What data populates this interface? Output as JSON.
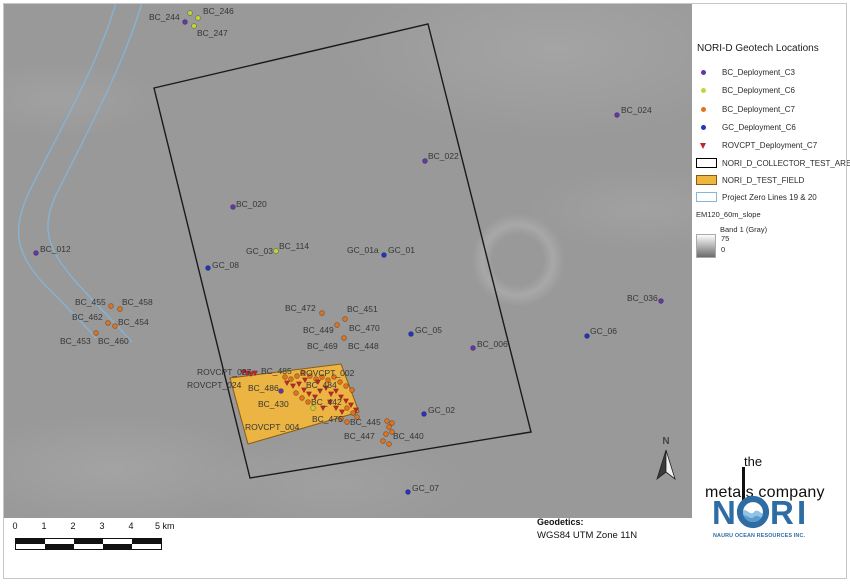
{
  "colors": {
    "map_bg": "#999999",
    "c3": "#6138a8",
    "c6": "#c3d438",
    "c7": "#e0731d",
    "gc": "#2433c0",
    "rovcpt": "#c0272d",
    "area_border": "#1a1a1a",
    "test_field_fill": "#eeb53f",
    "test_field_border": "#8a5a10",
    "zero_line": "#85b5d8",
    "nori_blue": "#2e6da4",
    "nori_light": "#8ec3e6"
  },
  "map": {
    "north": "N",
    "geodetics": {
      "title": "Geodetics:",
      "value": "WGS84 UTM Zone 11N"
    },
    "scalebar": {
      "labels": [
        "0",
        "1",
        "2",
        "3",
        "4"
      ],
      "unit_label": "5 km",
      "segments": 5
    },
    "test_area": {
      "name": "NORI_D_COLLECTOR_TEST_AREA",
      "corners": [
        [
          154,
          88
        ],
        [
          428,
          24
        ],
        [
          531,
          432
        ],
        [
          250,
          478
        ]
      ]
    },
    "test_field": {
      "name": "NORI_D_TEST_FIELD",
      "corners": [
        [
          230,
          378
        ],
        [
          341,
          364
        ],
        [
          359,
          412
        ],
        [
          248,
          444
        ]
      ]
    },
    "zero_lines": {
      "name": "Project Zero Lines 19 & 20",
      "paths": [
        "M116,2 C100,60 60,130 30,190 C12,228 14,252 45,285 C62,302 78,318 96,338",
        "M142,2 C126,60 86,135 56,195 C40,228 48,250 76,282 C95,303 112,320 132,342"
      ]
    },
    "dots": {
      "c3": [
        [
          185,
          22
        ],
        [
          617,
          115
        ],
        [
          425,
          161
        ],
        [
          233,
          207
        ],
        [
          36,
          253
        ],
        [
          473,
          348
        ],
        [
          661,
          301
        ],
        [
          281,
          391
        ]
      ],
      "c6": [
        [
          190,
          13
        ],
        [
          198,
          18
        ],
        [
          194,
          26
        ],
        [
          276,
          251
        ],
        [
          313,
          408
        ]
      ],
      "c7": [
        [
          111,
          306
        ],
        [
          120,
          309
        ],
        [
          108,
          323
        ],
        [
          115,
          326
        ],
        [
          96,
          333
        ],
        [
          322,
          313
        ],
        [
          345,
          319
        ],
        [
          337,
          325
        ],
        [
          344,
          338
        ],
        [
          387,
          421
        ],
        [
          392,
          423
        ],
        [
          389,
          427
        ],
        [
          392,
          432
        ],
        [
          386,
          434
        ],
        [
          383,
          441
        ],
        [
          389,
          444
        ],
        [
          285,
          377
        ],
        [
          291,
          379
        ],
        [
          297,
          376
        ],
        [
          303,
          373
        ],
        [
          310,
          376
        ],
        [
          316,
          379
        ],
        [
          322,
          377
        ],
        [
          328,
          380
        ],
        [
          334,
          377
        ],
        [
          340,
          382
        ],
        [
          346,
          386
        ],
        [
          352,
          390
        ],
        [
          296,
          393
        ],
        [
          302,
          398
        ],
        [
          308,
          402
        ],
        [
          347,
          408
        ],
        [
          353,
          413
        ],
        [
          341,
          419
        ],
        [
          347,
          422
        ],
        [
          357,
          417
        ]
      ],
      "gc": [
        [
          208,
          268
        ],
        [
          384,
          255
        ],
        [
          411,
          334
        ],
        [
          587,
          336
        ],
        [
          424,
          414
        ],
        [
          408,
          492
        ]
      ]
    },
    "triangles": [
      [
        243,
        372
      ],
      [
        247,
        373
      ],
      [
        251,
        374
      ],
      [
        255,
        373
      ],
      [
        287,
        383
      ],
      [
        293,
        386
      ],
      [
        299,
        384
      ],
      [
        304,
        390
      ],
      [
        309,
        394
      ],
      [
        315,
        397
      ],
      [
        320,
        391
      ],
      [
        326,
        388
      ],
      [
        331,
        394
      ],
      [
        336,
        391
      ],
      [
        341,
        397
      ],
      [
        346,
        401
      ],
      [
        305,
        380
      ],
      [
        318,
        382
      ],
      [
        330,
        402
      ],
      [
        336,
        408
      ],
      [
        342,
        412
      ],
      [
        351,
        405
      ],
      [
        323,
        408
      ],
      [
        356,
        410
      ]
    ],
    "labels": [
      {
        "text": "BC_244",
        "x": 149,
        "y": 12
      },
      {
        "text": "BC_246",
        "x": 203,
        "y": 6
      },
      {
        "text": "BC_247",
        "x": 197,
        "y": 28
      },
      {
        "text": "BC_024",
        "x": 621,
        "y": 105
      },
      {
        "text": "BC_022",
        "x": 428,
        "y": 151
      },
      {
        "text": "BC_020",
        "x": 236,
        "y": 199
      },
      {
        "text": "BC_012",
        "x": 40,
        "y": 244
      },
      {
        "text": "GC_08",
        "x": 212,
        "y": 260
      },
      {
        "text": "GC_03",
        "x": 246,
        "y": 246
      },
      {
        "text": "BC_114",
        "x": 279,
        "y": 241
      },
      {
        "text": "GC_01a",
        "x": 347,
        "y": 245
      },
      {
        "text": "GC_01",
        "x": 388,
        "y": 245
      },
      {
        "text": "BC_455",
        "x": 75,
        "y": 297
      },
      {
        "text": "BC_458",
        "x": 122,
        "y": 297
      },
      {
        "text": "BC_462",
        "x": 72,
        "y": 312
      },
      {
        "text": "BC_454",
        "x": 118,
        "y": 317
      },
      {
        "text": "BC_453",
        "x": 60,
        "y": 336
      },
      {
        "text": "BC_460",
        "x": 98,
        "y": 336
      },
      {
        "text": "BC_472",
        "x": 285,
        "y": 303
      },
      {
        "text": "BC_451",
        "x": 347,
        "y": 304
      },
      {
        "text": "BC_449",
        "x": 303,
        "y": 325
      },
      {
        "text": "BC_470",
        "x": 349,
        "y": 323
      },
      {
        "text": "BC_469",
        "x": 307,
        "y": 341
      },
      {
        "text": "BC_448",
        "x": 348,
        "y": 341
      },
      {
        "text": "BC_036",
        "x": 627,
        "y": 293
      },
      {
        "text": "GC_05",
        "x": 415,
        "y": 325
      },
      {
        "text": "GC_06",
        "x": 590,
        "y": 326
      },
      {
        "text": "BC_006",
        "x": 477,
        "y": 339
      },
      {
        "text": "ROVCPT_027",
        "x": 197,
        "y": 367
      },
      {
        "text": "BC_485",
        "x": 261,
        "y": 366
      },
      {
        "text": "ROVCPT_002",
        "x": 300,
        "y": 368
      },
      {
        "text": "ROVCPT_024",
        "x": 187,
        "y": 380
      },
      {
        "text": "BC_486",
        "x": 248,
        "y": 383
      },
      {
        "text": "BC_484",
        "x": 306,
        "y": 380
      },
      {
        "text": "BC_430",
        "x": 258,
        "y": 399
      },
      {
        "text": "BC_442",
        "x": 311,
        "y": 397
      },
      {
        "text": "ROVCPT_004",
        "x": 245,
        "y": 422
      },
      {
        "text": "BC_475",
        "x": 312,
        "y": 414
      },
      {
        "text": "BC_445",
        "x": 350,
        "y": 417
      },
      {
        "text": "BC_447",
        "x": 344,
        "y": 431
      },
      {
        "text": "BC_440",
        "x": 393,
        "y": 431
      },
      {
        "text": "GC_02",
        "x": 428,
        "y": 405
      },
      {
        "text": "GC_07",
        "x": 412,
        "y": 483
      }
    ]
  },
  "legend": {
    "title": "NORI-D Geotech Locations",
    "point_items": [
      {
        "label": "BC_Deployment_C3",
        "type": "c3",
        "shape": "circle"
      },
      {
        "label": "BC_Deployment_C6",
        "type": "c6",
        "shape": "circle"
      },
      {
        "label": "BC_Deployment_C7",
        "type": "c7",
        "shape": "circle"
      },
      {
        "label": "GC_Deployment_C6",
        "type": "gc",
        "shape": "circle"
      },
      {
        "label": "ROVCPT_Deployment_C7",
        "type": "rovcpt",
        "shape": "triangle"
      }
    ],
    "shape_items": [
      {
        "label": "NORI_D_COLLECTOR_TEST_AREA",
        "fill": "#ffffff",
        "border": "#000000"
      },
      {
        "label": "NORI_D_TEST_FIELD",
        "fill": "#eeb53f",
        "border": "#8a5a10"
      },
      {
        "label": "Project Zero Lines 19 & 20",
        "fill": "#ffffff",
        "border": "#85b5d8"
      }
    ],
    "raster": {
      "name": "EM120_60m_slope",
      "band": "Band 1 (Gray)",
      "max": "75",
      "min": "0"
    }
  },
  "logos": {
    "tmc": {
      "the": "the",
      "metals_pre": "meta",
      "metals_post": "s company"
    },
    "nori": {
      "n": "N",
      "r": "R",
      "i": "I",
      "subtitle": "NAURU OCEAN RESOURCES INC."
    }
  }
}
